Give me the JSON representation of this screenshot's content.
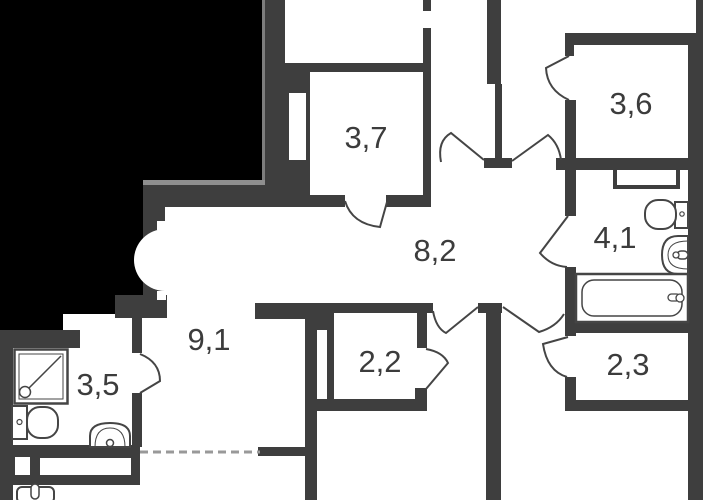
{
  "plan": {
    "type": "apartment-floor-plan",
    "rooms": [
      {
        "id": "room-3-7",
        "label": "3,7"
      },
      {
        "id": "room-3-6",
        "label": "3,6"
      },
      {
        "id": "hall-8-2",
        "label": "8,2"
      },
      {
        "id": "bath-4-1",
        "label": "4,1"
      },
      {
        "id": "corridor-9-1",
        "label": "9,1"
      },
      {
        "id": "room-2-2",
        "label": "2,2"
      },
      {
        "id": "room-2-3",
        "label": "2,3"
      },
      {
        "id": "bath-3-5",
        "label": "3,5"
      }
    ],
    "fixtures": [
      "shower-tray",
      "toilet",
      "wash-basin",
      "bathtub",
      "toilet",
      "wash-basin",
      "kitchen-sink"
    ],
    "colors": {
      "wall": "#3e3e3e",
      "outside_mask": "#000000",
      "background": "#ffffff",
      "thin_line": "#454545",
      "dashed_line": "#999999",
      "edge_highlight": "#8a8a8a"
    }
  }
}
